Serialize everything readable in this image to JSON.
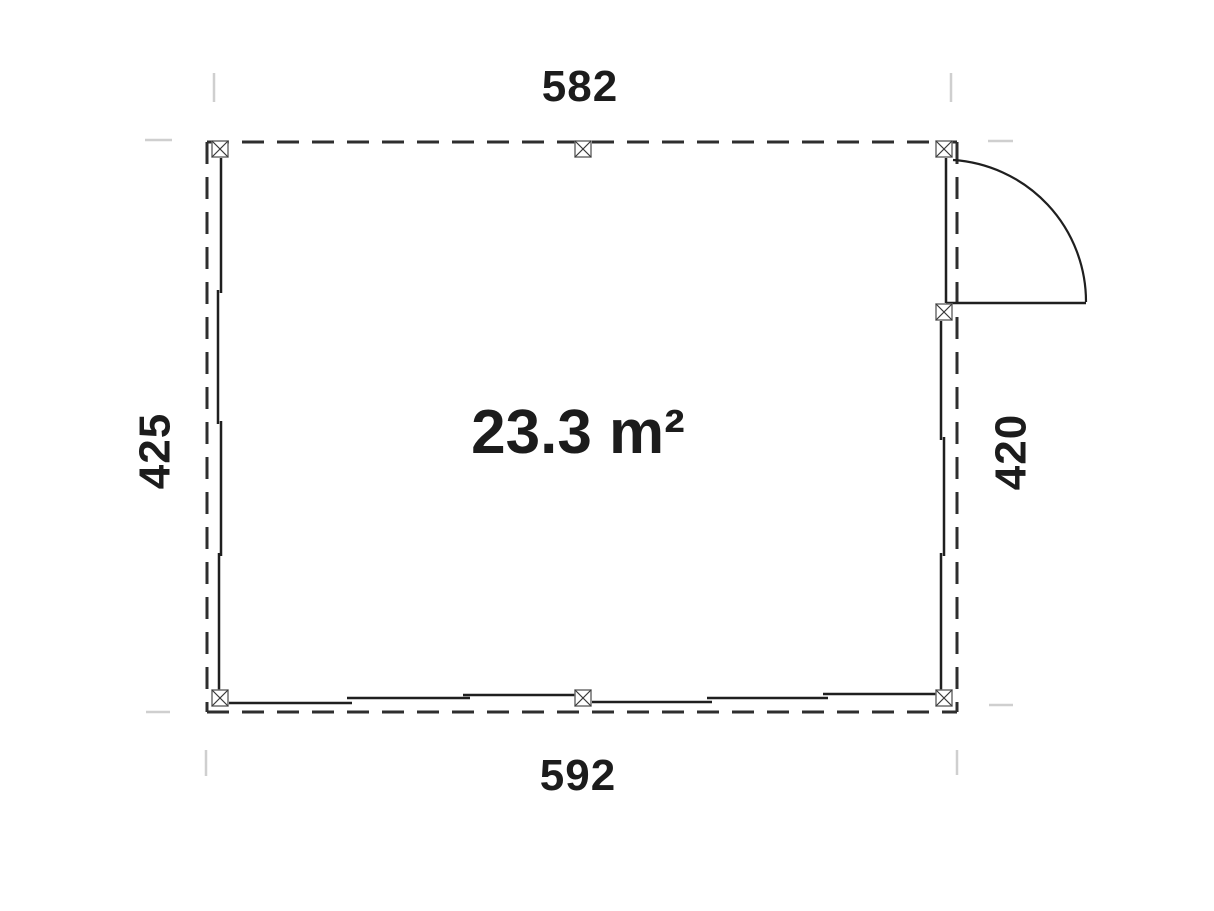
{
  "plan": {
    "title": "floor-plan",
    "area_label": "23.3 m²",
    "dimensions": {
      "top_width": "582",
      "bottom_width": "592",
      "left_depth": "425",
      "right_depth": "420"
    },
    "colors": {
      "wall": "#1f1f1f",
      "outline": "#2e2e2e",
      "door": "#1f1f1f",
      "post": "#6f6f6f",
      "post_cross": "#3a3a3a",
      "extension": "#cfcfcf",
      "text": "#1c1c1c",
      "background": "#ffffff"
    }
  }
}
